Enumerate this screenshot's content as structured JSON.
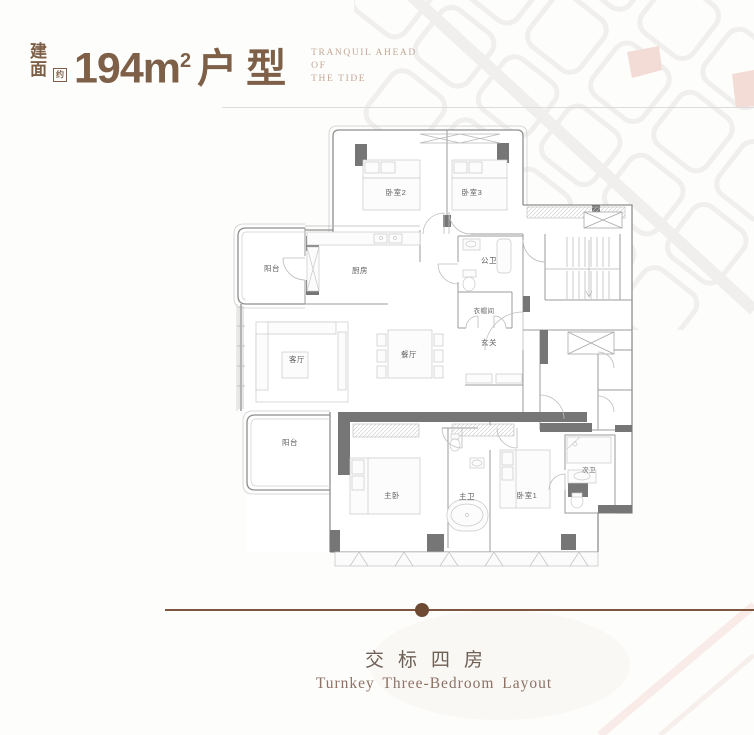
{
  "header": {
    "area_label_char1": "建",
    "area_label_char2": "面",
    "area_approx_char": "约",
    "area_number": "194m",
    "area_superscript": "2",
    "area_type": "户型",
    "tagline_line1": "TRANQUIL AHEAD",
    "tagline_line2": "OF",
    "tagline_line3": "THE TIDE"
  },
  "plan": {
    "rooms": [
      {
        "label": "卧室2"
      },
      {
        "label": "卧室3"
      },
      {
        "label": "阳台"
      },
      {
        "label": "厨房"
      },
      {
        "label": "公卫"
      },
      {
        "label": "衣帽间"
      },
      {
        "label": "玄关"
      },
      {
        "label": "客厅"
      },
      {
        "label": "餐厅"
      },
      {
        "label": "阳台"
      },
      {
        "label": "主卧"
      },
      {
        "label": "主卫"
      },
      {
        "label": "卧室1"
      },
      {
        "label": "次卫"
      }
    ]
  },
  "footer": {
    "title_cn": "交标四房",
    "title_en": "Turnkey Three-Bedroom Layout"
  },
  "colors": {
    "accent_brown": "#7e6048",
    "tagline_brown": "#c3a795",
    "divider_brown": "#7c563f",
    "footer_cn_color": "#6f6055",
    "footer_en_color": "#8d7164",
    "wall_dark": "#767676",
    "wall_line": "#8e8e8e"
  }
}
